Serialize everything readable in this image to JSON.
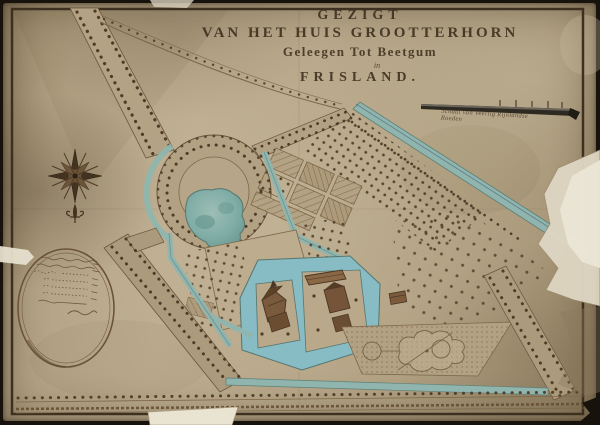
{
  "title": {
    "line1": "GEZIGT",
    "line2": "VAN HET HUIS GROOTTERHORN",
    "line3": "Geleegen Tot Beetgum",
    "line4": "in",
    "line5": "FRISLAND."
  },
  "scale_bar": {
    "caption": "Schaal van Veertig Rijnlandse Roeden"
  },
  "colors": {
    "paper": "#b6a588",
    "ink": "#3a2d1c",
    "canal_water": "#8fb5ae",
    "moat_water": "#88bcc4",
    "pond_water": "#7fada6",
    "tree": "#4f3c28",
    "backing": "#17120b",
    "torn_patch": "#e9e3d2"
  },
  "features": [
    "nw-avenue",
    "ring-walk",
    "round-pond",
    "kitchen-garden-beds",
    "orchard-ne",
    "great-lawn",
    "moat",
    "main-house",
    "outbuildings",
    "broderie-parterre",
    "round-parterre",
    "se-avenue",
    "west-avenue",
    "bottom-road",
    "compass-rose",
    "oval-cartouche",
    "scale-bar"
  ]
}
